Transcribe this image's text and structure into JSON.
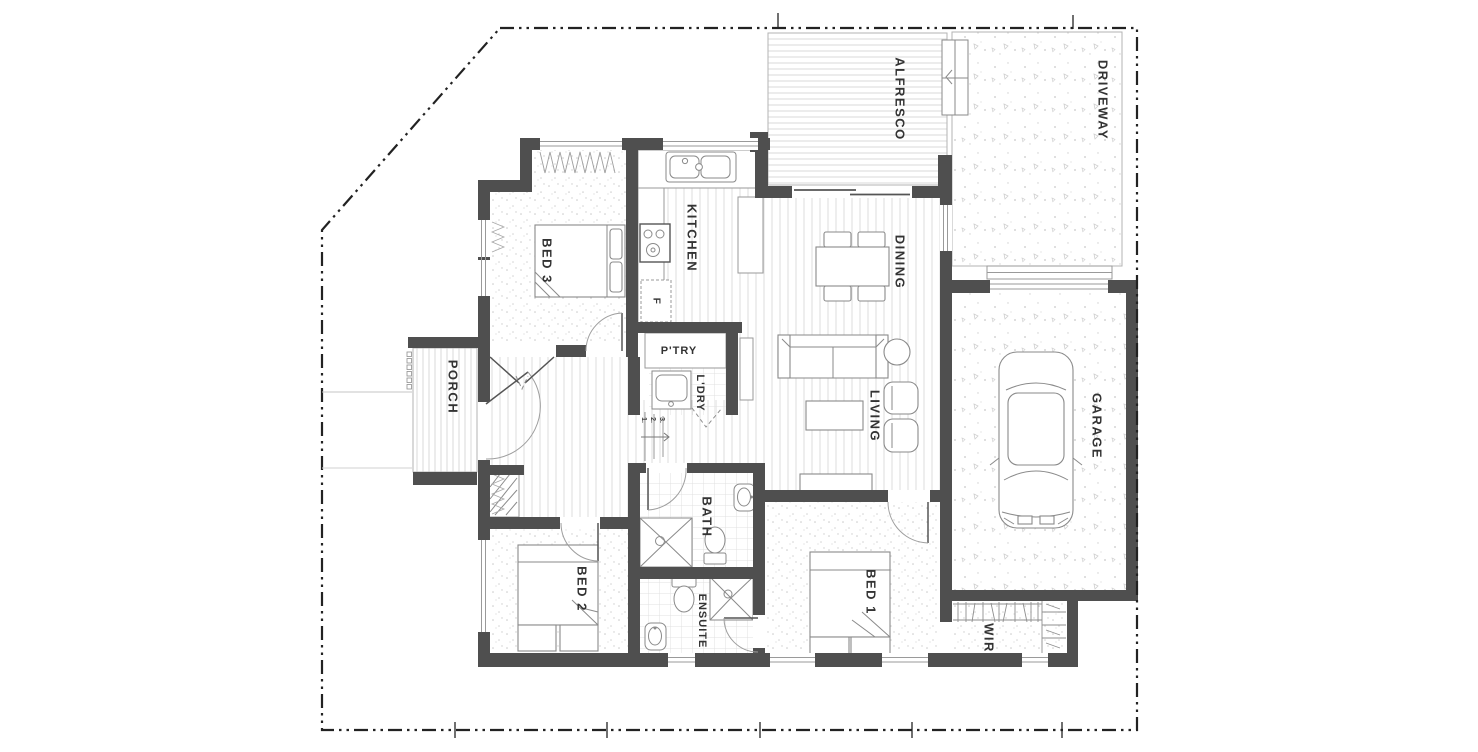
{
  "plan": {
    "rooms": {
      "alfresco": "ALFRESCO",
      "driveway": "DRIVEWAY",
      "kitchen": "KITCHEN",
      "dining": "DINING",
      "living": "LIVING",
      "garage": "GARAGE",
      "porch": "PORCH",
      "bed1": "BED 1",
      "bed2": "BED 2",
      "bed3": "BED 3",
      "bath": "BATH",
      "ensuite": "ENSUITE",
      "wir": "WIR",
      "pantry": "P'TRY",
      "laundry": "L'DRY"
    },
    "annotations": {
      "fridge": "F",
      "steps": [
        "1.",
        "2.",
        "3."
      ]
    },
    "colors": {
      "wall": "#4f4f4f",
      "text": "#333333",
      "boundary": "#222222",
      "floor_line": "#dcdcdc"
    }
  }
}
